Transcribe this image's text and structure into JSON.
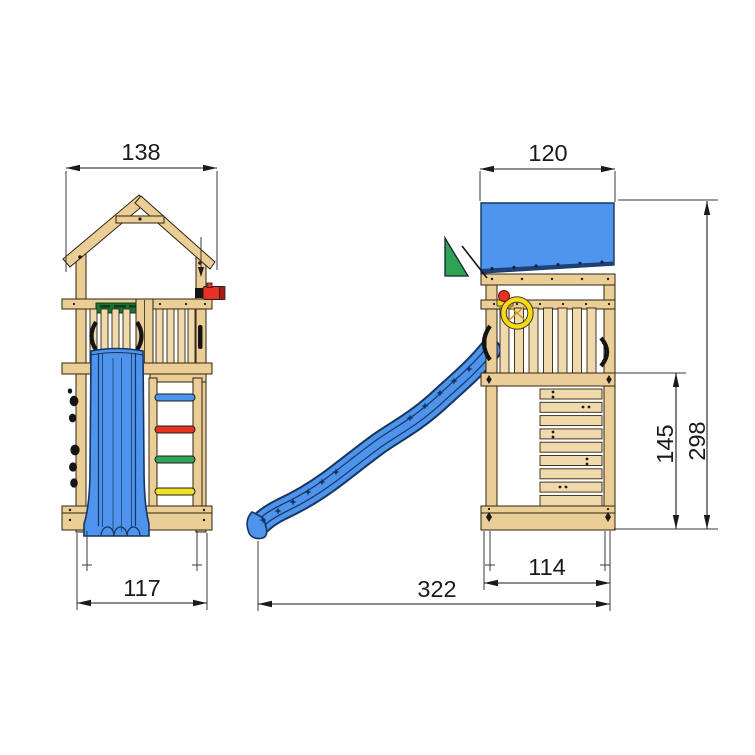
{
  "drawing": {
    "front_view": {
      "roof_width_label": "138",
      "base_width_label": "117"
    },
    "side_view": {
      "roof_depth_label": "120",
      "platform_height_label": "145",
      "total_height_label": "298",
      "base_depth_label": "114",
      "total_length_label": "322"
    }
  },
  "colors": {
    "wood": "#EBCD96",
    "outline": "#2e2414",
    "slide_blue": "#4E93EC",
    "slide_navy": "#17355E",
    "roof_blue": "#4E95EE",
    "flag_green": "#2FA356",
    "board_green": "#1B7431",
    "accent_red": "#E63223",
    "wheel_yellow": "#F7D916",
    "rung_blue": "#4E95EE",
    "rung_red": "#E63223",
    "rung_green": "#2FA356",
    "rung_yellow": "#F2E123",
    "dimension": "#1a1a1a"
  }
}
